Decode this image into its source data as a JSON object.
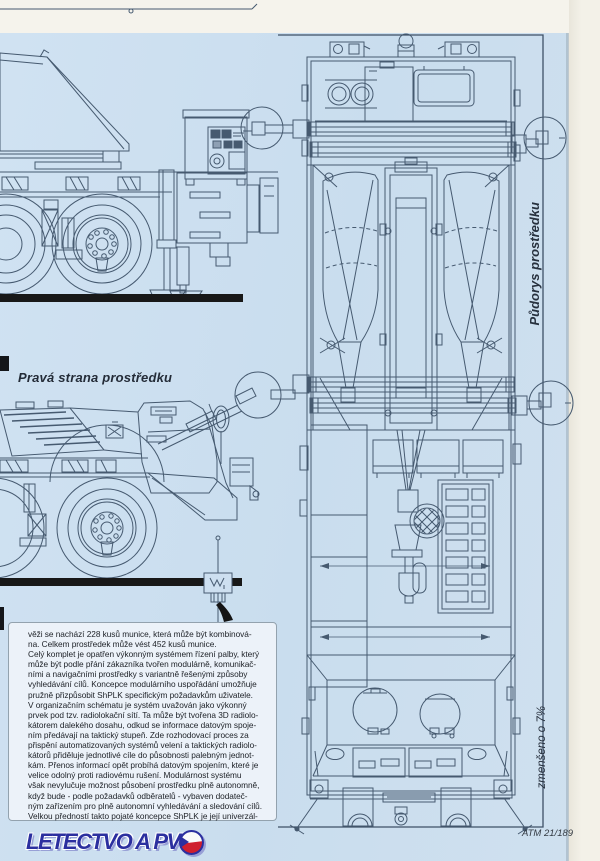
{
  "captions": {
    "side_view": "Pravá strana prostředku",
    "plan_view": "Půdorys prostředku",
    "scale_note": "zmenšeno o 7%",
    "page_ref": "ATM 21/189"
  },
  "logo": {
    "text": "LETECTVO A PV"
  },
  "article": {
    "text": "věži se nachází 228 kusů munice, která může být kombinová-\nna. Celkem prostředek může vést 452 kusů munice.\nCelý komplet je opatřen výkonným systémem řízení palby, který\nmůže být podle přání zákazníka tvořen modulárně, komunikač-\nními a navigačními prostředky s variantně řešenými způsoby\nvyhledávání cílů. Koncepce modulárního uspořádání umožňuje\npružně přizpůsobit ShPLK specifickým požadavkům uživatele.\nV organizačním schématu je systém uvažován jako výkonný\nprvek pod tzv. radiolokační sítí. Ta může být tvořena 3D radiolo-\nkátorem dalekého dosahu, odkud se informace datovým spoje-\nním předávají na taktický stupeň. Zde rozhodovací proces za\npřispění automatizovaných systémů velení a taktických radiolo-\nkátorů přiděluje jednotlivé cíle do působnosti palebným jednot-\nkám. Přenos informací opět probíhá datovým spojením, které je\nvelice odolný proti radiovému rušení. Modulárnost systému\nvšak nevylučuje možnost působení prostředku plně autonomně,\nkdyž bude - podle požadavků odběratelů - vybaven dodateč-\nným zařízením pro plně autonomní vyhledávání a sledování cílů.\nVelkou předností takto pojaté koncepce ShPLK je její univerzál-"
  },
  "colors": {
    "page_blue": "#cde0f0",
    "line": "#465a70",
    "logo_blue": "#2b2f9f",
    "flag_red": "#cf1f2e"
  }
}
